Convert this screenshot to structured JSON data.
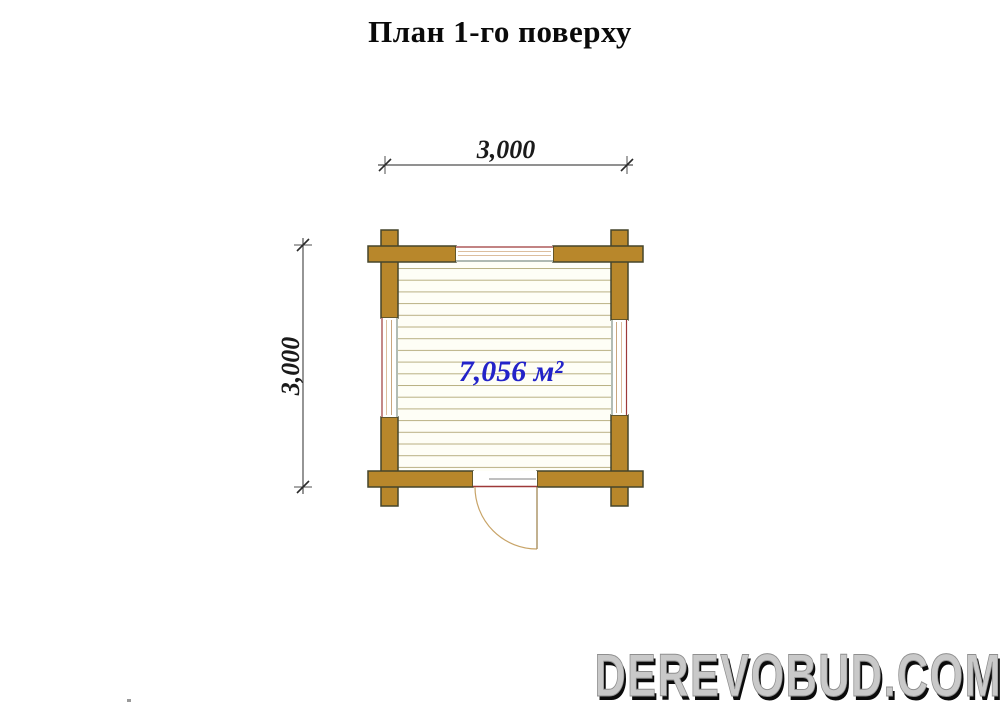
{
  "title": "План 1-го поверху",
  "plan": {
    "area_label": "7,056 м²",
    "dim_width": "3,000",
    "dim_height": "3,000"
  },
  "watermark": "DEREVOBUD.COM",
  "colors": {
    "log_fill": "#B8872B",
    "log_outline": "#45452B",
    "floor_bg": "#FEFEF6",
    "floor_line": "#B9B083",
    "window_frame_red": "#9E3939",
    "window_line_tan": "#DCBE9E",
    "window_inner_gray": "#7F8F83",
    "door_arc": "#C8A468",
    "door_gray": "#999999",
    "area_text_blue": "#2323C8",
    "dimension_gray": "#4F4F4F",
    "watermark_gray": "#C9C9C9",
    "title_black": "#0A0A0A"
  }
}
